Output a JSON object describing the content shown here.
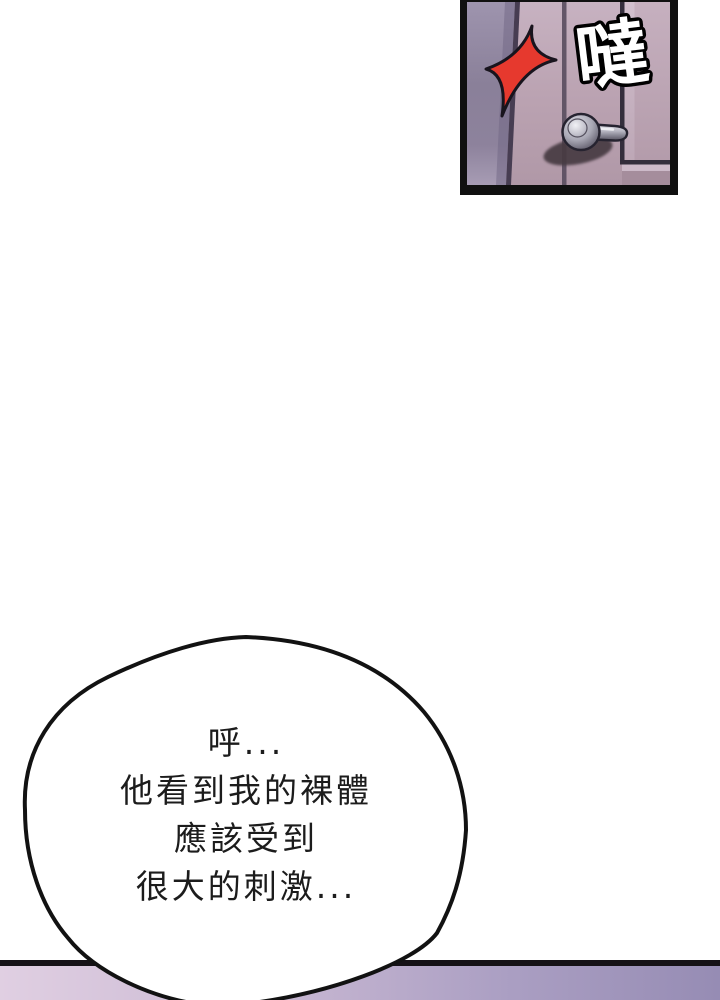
{
  "page": {
    "width_px": 720,
    "height_px": 1000,
    "background": "#ffffff"
  },
  "door_panel": {
    "sfx_text": "噠",
    "colors": {
      "panel_border": "#101010",
      "door_top": "#c7b2c1",
      "door_bottom": "#b098a7",
      "frame_strip_top": "#9e94ae",
      "frame_strip_bottom": "#a79cb4",
      "strip_edge_line": "#473d52",
      "inset_bevel_dark": "#342e3c",
      "inset_bevel_light": "#d2c0ce",
      "spark_red": "#e6392e",
      "spark_outline": "#18141d",
      "handle_metal_light": "#e9e9ef",
      "handle_metal_dark": "#555260",
      "handle_outline": "#262330",
      "handle_shadow": "#463a43",
      "sfx_fill": "#ffffff",
      "sfx_outline": "#000000"
    }
  },
  "speech_bubble": {
    "fill": "#ffffff",
    "outline": "#121212",
    "text_color": "#1c1c1c",
    "lines": [
      "呼...",
      "他看到我的裸體",
      "應該受到",
      "很大的刺激..."
    ]
  },
  "next_panel_strip": {
    "border_color": "#161217",
    "gradient_left": "#e0cfe2",
    "gradient_right": "#968cb4"
  }
}
